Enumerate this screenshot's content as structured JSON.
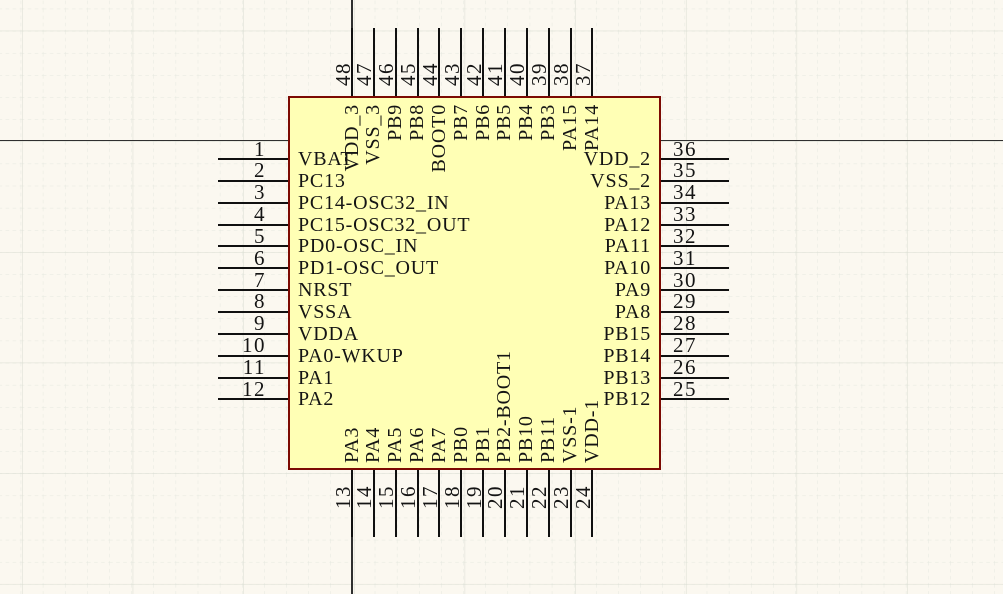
{
  "view": {
    "type": "schematic-canvas",
    "component_kind": "48-pin IC symbol"
  },
  "component": {
    "sides": {
      "left": [
        {
          "num": "1",
          "name": "VBAT"
        },
        {
          "num": "2",
          "name": "PC13"
        },
        {
          "num": "3",
          "name": "PC14-OSC32_IN"
        },
        {
          "num": "4",
          "name": "PC15-OSC32_OUT"
        },
        {
          "num": "5",
          "name": "PD0-OSC_IN"
        },
        {
          "num": "6",
          "name": "PD1-OSC_OUT"
        },
        {
          "num": "7",
          "name": "NRST"
        },
        {
          "num": "8",
          "name": "VSSA"
        },
        {
          "num": "9",
          "name": "VDDA"
        },
        {
          "num": "10",
          "name": "PA0-WKUP"
        },
        {
          "num": "11",
          "name": "PA1"
        },
        {
          "num": "12",
          "name": "PA2"
        }
      ],
      "right": [
        {
          "num": "36",
          "name": "VDD_2"
        },
        {
          "num": "35",
          "name": "VSS_2"
        },
        {
          "num": "34",
          "name": "PA13"
        },
        {
          "num": "33",
          "name": "PA12"
        },
        {
          "num": "32",
          "name": "PA11"
        },
        {
          "num": "31",
          "name": "PA10"
        },
        {
          "num": "30",
          "name": "PA9"
        },
        {
          "num": "29",
          "name": "PA8"
        },
        {
          "num": "28",
          "name": "PB15"
        },
        {
          "num": "27",
          "name": "PB14"
        },
        {
          "num": "26",
          "name": "PB13"
        },
        {
          "num": "25",
          "name": "PB12"
        }
      ],
      "top": [
        {
          "num": "48",
          "name": "VDD_3"
        },
        {
          "num": "47",
          "name": "VSS_3"
        },
        {
          "num": "46",
          "name": "PB9"
        },
        {
          "num": "45",
          "name": "PB8"
        },
        {
          "num": "44",
          "name": "BOOT0"
        },
        {
          "num": "43",
          "name": "PB7"
        },
        {
          "num": "42",
          "name": "PB6"
        },
        {
          "num": "41",
          "name": "PB5"
        },
        {
          "num": "40",
          "name": "PB4"
        },
        {
          "num": "39",
          "name": "PB3"
        },
        {
          "num": "38",
          "name": "PA15"
        },
        {
          "num": "37",
          "name": "PA14"
        }
      ],
      "bottom": [
        {
          "num": "13",
          "name": "PA3"
        },
        {
          "num": "14",
          "name": "PA4"
        },
        {
          "num": "15",
          "name": "PA5"
        },
        {
          "num": "16",
          "name": "PA6"
        },
        {
          "num": "17",
          "name": "PA7"
        },
        {
          "num": "18",
          "name": "PB0"
        },
        {
          "num": "19",
          "name": "PB1"
        },
        {
          "num": "20",
          "name": "PB2-BOOT1"
        },
        {
          "num": "21",
          "name": "PB10"
        },
        {
          "num": "22",
          "name": "PB11"
        },
        {
          "num": "23",
          "name": "VSS-1"
        },
        {
          "num": "24",
          "name": "VDD-1"
        }
      ]
    }
  },
  "colors": {
    "bg": "#FBF8F0",
    "grid_minor": "#E5E8DF",
    "grid_major": "#DADDD2",
    "body_fill": "#FFFFB5",
    "body_border": "#7C0A02",
    "pin_line": "#101010",
    "text": "#141414",
    "crosshair": "#2F2F2F"
  }
}
